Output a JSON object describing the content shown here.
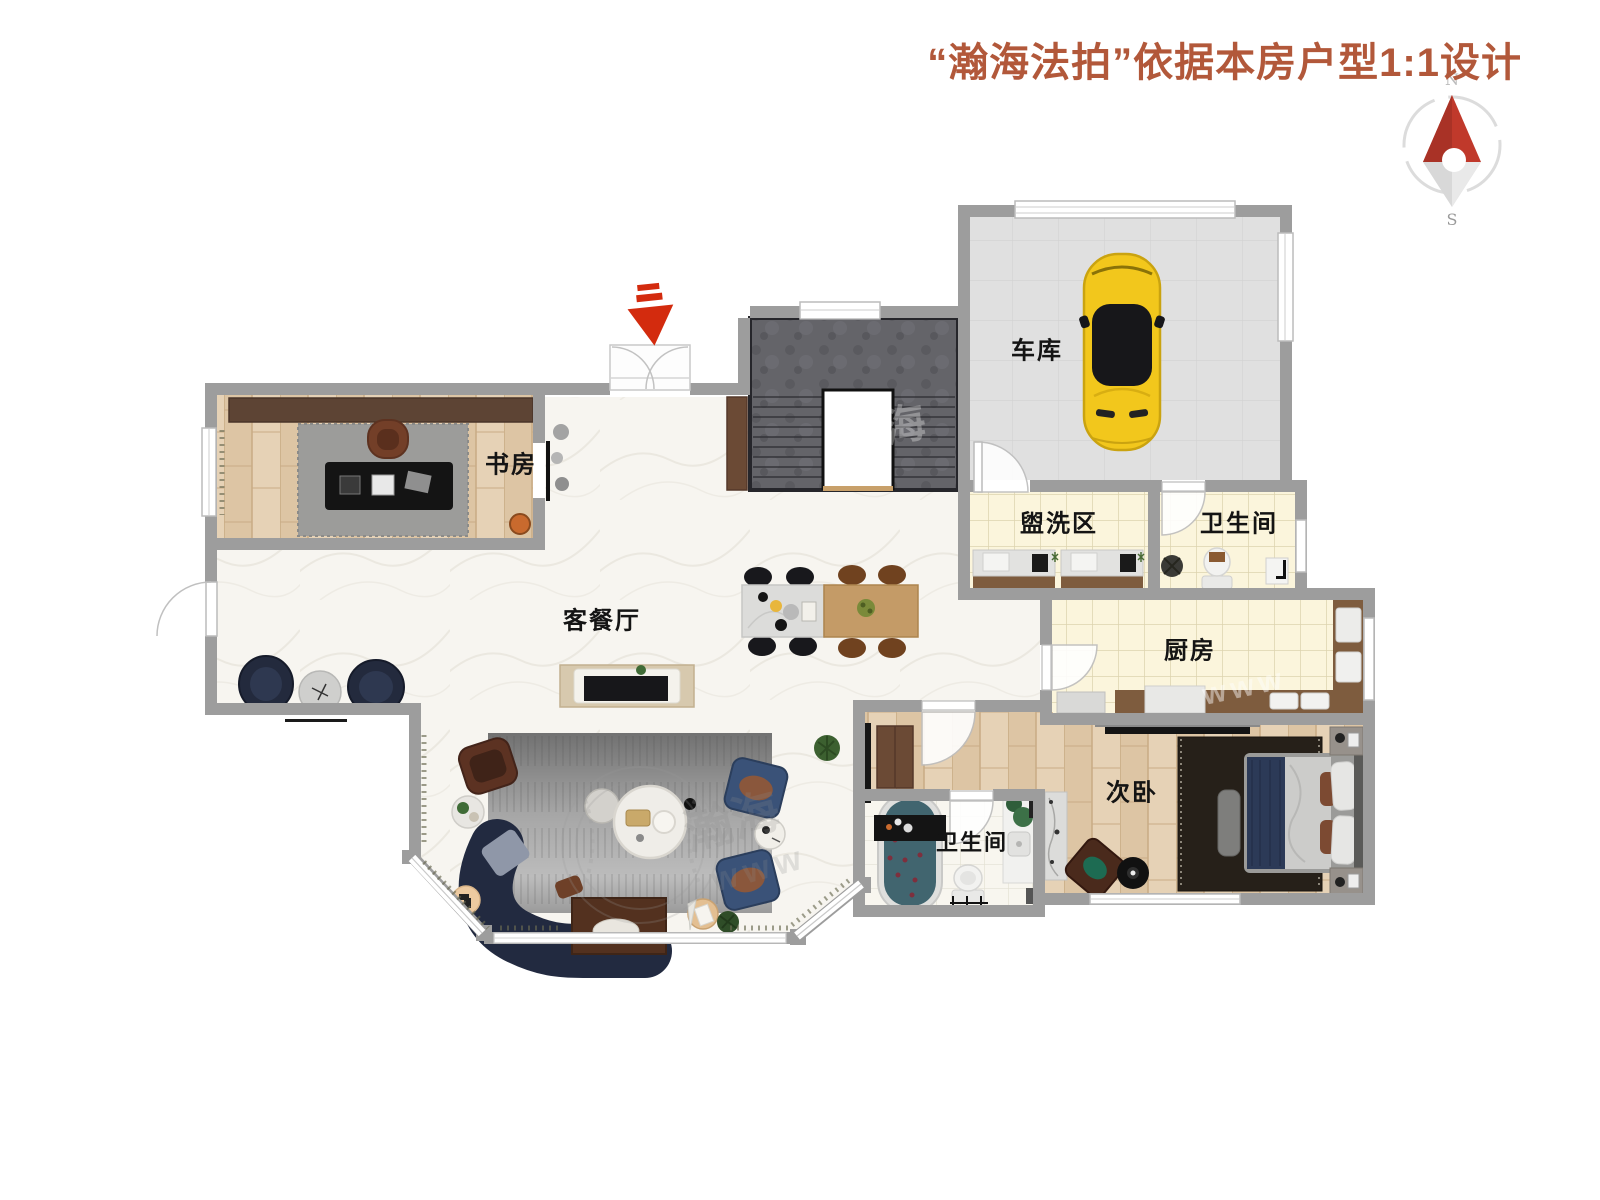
{
  "title": {
    "text": "“瀚海法拍”依据本房户型1:1设计",
    "color": "#b2583a"
  },
  "compass": {
    "north": "N",
    "south": "S"
  },
  "rooms": {
    "study": {
      "label": "书房"
    },
    "living_dining": {
      "label": "客餐厅"
    },
    "garage": {
      "label": "车库"
    },
    "wash_area": {
      "label": "盥洗区"
    },
    "bathroom_top": {
      "label": "卫生间"
    },
    "kitchen": {
      "label": "厨房"
    },
    "bedroom": {
      "label": "次卧"
    },
    "bathroom_lower": {
      "label": "卫生间"
    }
  },
  "watermark": {
    "brand": "瀚海",
    "web": "www"
  },
  "colors": {
    "wall": "#9d9d9d",
    "title": "#b2583a",
    "entrance_arrow_red": "#d32b0e",
    "compass_red": "#c0392b",
    "car_yellow": "#f2c71c"
  }
}
